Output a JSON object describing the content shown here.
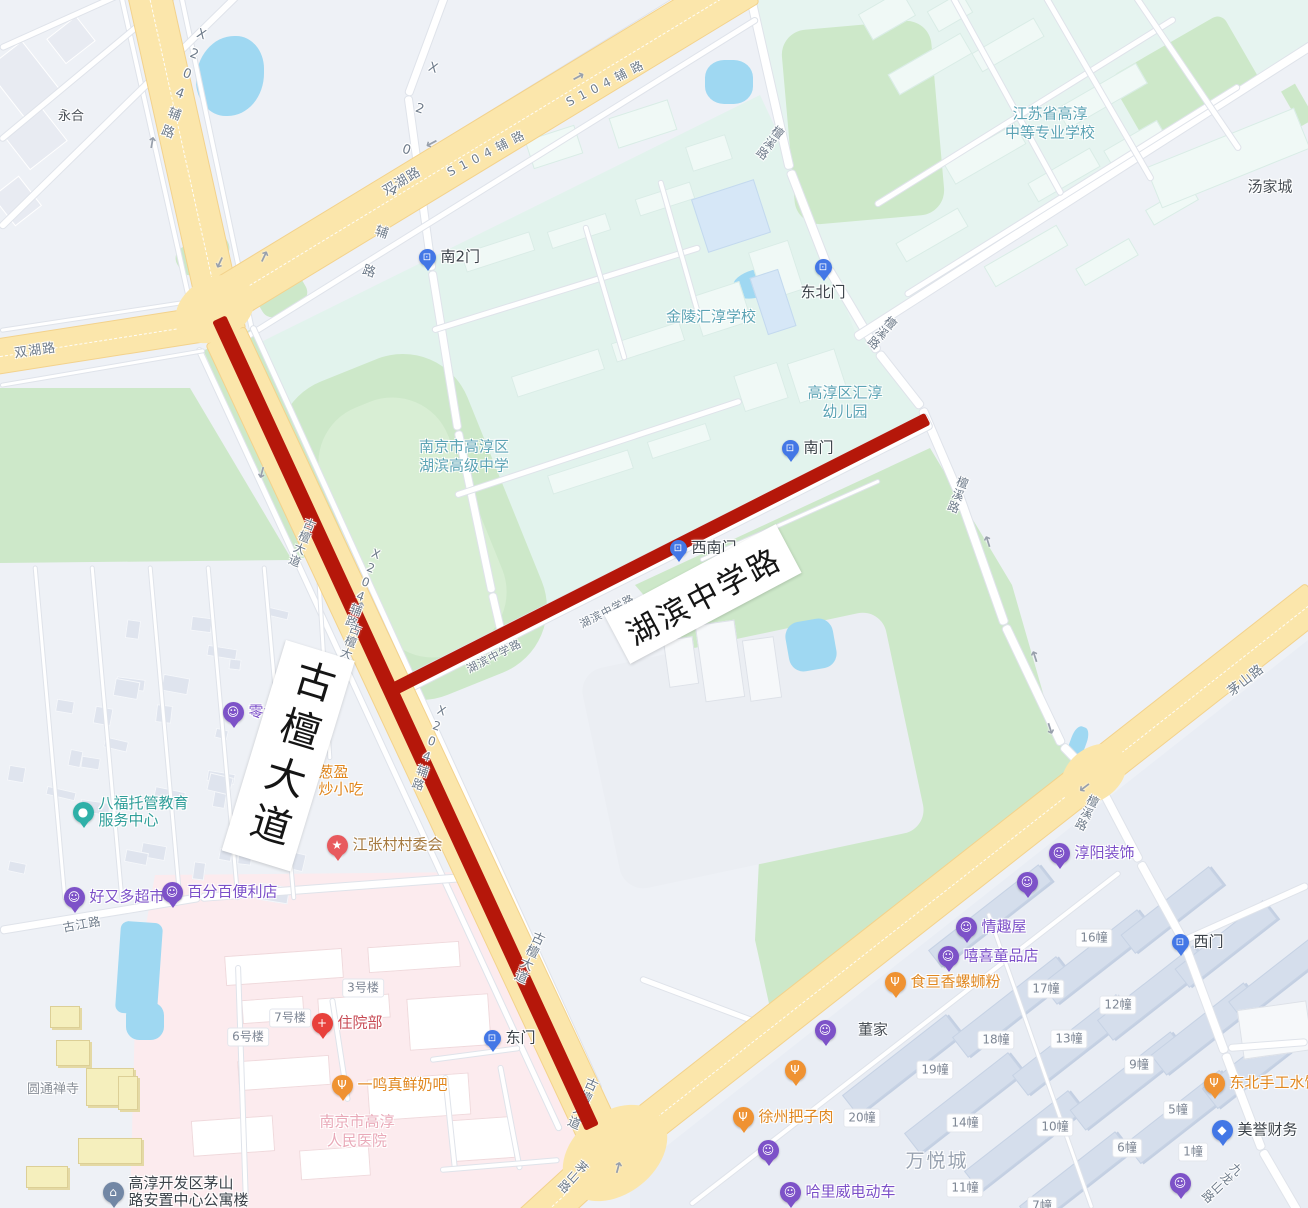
{
  "map_size": {
    "w": 1308,
    "h": 1208
  },
  "route": {
    "color": "#b5170a",
    "segments": [
      {
        "road": "古檀大道",
        "x1": 219,
        "y1": 318,
        "x2": 592,
        "y2": 1127,
        "w": 15
      },
      {
        "road": "湖滨中学路",
        "x1": 395,
        "y1": 688,
        "x2": 928,
        "y2": 418,
        "w": 13
      }
    ]
  },
  "highlight_labels": {
    "vertical": "古檀大道",
    "diagonal": "湖滨中学路"
  },
  "road_labels": [
    {
      "t": "双湖路",
      "x": 35,
      "y": 349,
      "r": -8,
      "s": 13
    },
    {
      "t": "双湖路",
      "x": 401,
      "y": 180,
      "r": -31,
      "s": 13
    },
    {
      "t": "S104辅路",
      "x": 488,
      "y": 152,
      "r": -27,
      "s": 12,
      "ls": 6
    },
    {
      "t": "S104辅路",
      "x": 607,
      "y": 82,
      "r": -27,
      "s": 12,
      "ls": 6
    },
    {
      "t": "X204辅路",
      "x": 183,
      "y": 85,
      "r": 20,
      "v": 1,
      "s": 13,
      "ls": 6
    },
    {
      "t": "X204辅路",
      "x": 396,
      "y": 182,
      "r": 18,
      "v": 1,
      "s": 13,
      "ls": 28
    },
    {
      "t": "X204辅路",
      "x": 364,
      "y": 588,
      "r": 20,
      "v": 1,
      "s": 12,
      "ls": 1
    },
    {
      "t": "X204辅路",
      "x": 430,
      "y": 748,
      "r": 18,
      "v": 1,
      "s": 12,
      "ls": 2
    },
    {
      "t": "古檀大道辅路",
      "x": 344,
      "y": 660,
      "r": 20,
      "v": 1,
      "s": 12,
      "ls": 1
    },
    {
      "t": "古檀大道",
      "x": 302,
      "y": 543,
      "r": 22,
      "v": 1,
      "s": 12,
      "ls": 1
    },
    {
      "t": "古檀大道",
      "x": 528,
      "y": 957,
      "r": 24,
      "v": 1,
      "s": 13,
      "ls": 1
    },
    {
      "t": "古檀大道",
      "x": 581,
      "y": 1103,
      "r": 24,
      "v": 1,
      "s": 13,
      "ls": 1,
      "under": 1
    },
    {
      "t": "茅山路",
      "x": 1245,
      "y": 679,
      "r": -38,
      "s": 13
    },
    {
      "t": "茅山路",
      "x": 573,
      "y": 1177,
      "r": 42,
      "v": 1,
      "s": 12
    },
    {
      "t": "檀溪路",
      "x": 770,
      "y": 143,
      "r": 36,
      "v": 1,
      "s": 12
    },
    {
      "t": "檀溪路",
      "x": 882,
      "y": 333,
      "r": 40,
      "v": 1,
      "s": 12
    },
    {
      "t": "檀溪路",
      "x": 958,
      "y": 495,
      "r": 20,
      "v": 1,
      "s": 12
    },
    {
      "t": "檀溪路",
      "x": 1087,
      "y": 813,
      "r": 26,
      "v": 1,
      "s": 12
    },
    {
      "t": "九龙山路",
      "x": 1222,
      "y": 1183,
      "r": 46,
      "v": 1,
      "s": 12
    },
    {
      "t": "古江路",
      "x": 82,
      "y": 924,
      "r": -10,
      "s": 12
    },
    {
      "t": "湖滨中学路",
      "x": 494,
      "y": 656,
      "r": -27,
      "s": 11
    },
    {
      "t": "湖滨中学路",
      "x": 607,
      "y": 611,
      "r": -27,
      "s": 11
    }
  ],
  "area_labels": [
    {
      "lines": [
        "金陵汇淳学校"
      ],
      "x": 711,
      "y": 317,
      "cls": "teal",
      "s": 15
    },
    {
      "lines": [
        "高淳区汇淳",
        "幼儿园"
      ],
      "x": 845,
      "y": 402,
      "cls": "teal",
      "s": 15
    },
    {
      "lines": [
        "南京市高淳区",
        "湖滨高级中学"
      ],
      "x": 464,
      "y": 456,
      "cls": "teal",
      "s": 15
    },
    {
      "lines": [
        "江苏省高淳",
        "中等专业学校"
      ],
      "x": 1050,
      "y": 123,
      "cls": "teal",
      "s": 15
    },
    {
      "lines": [
        "永合"
      ],
      "x": 71,
      "y": 117,
      "cls": "dark",
      "s": 13
    },
    {
      "lines": [
        "汤家城"
      ],
      "x": 1270,
      "y": 187,
      "cls": "dark",
      "s": 15
    },
    {
      "lines": [
        "董家"
      ],
      "x": 873,
      "y": 1030,
      "cls": "dark",
      "s": 15
    },
    {
      "lines": [
        "万悦城"
      ],
      "x": 937,
      "y": 1162,
      "cls": "big-gray",
      "s": 19
    },
    {
      "lines": [
        "圆通禅寺"
      ],
      "x": 53,
      "y": 1090,
      "cls": "gray",
      "s": 13
    },
    {
      "lines": [
        "南京市高淳",
        "人民医院"
      ],
      "x": 357,
      "y": 1131,
      "cls": "pink",
      "s": 15
    }
  ],
  "building_labels": [
    {
      "t": "3号楼",
      "x": 363,
      "y": 988
    },
    {
      "t": "7号楼",
      "x": 290,
      "y": 1018
    },
    {
      "t": "6号楼",
      "x": 248,
      "y": 1037
    },
    {
      "t": "16幢",
      "x": 1094,
      "y": 938
    },
    {
      "t": "17幢",
      "x": 1046,
      "y": 989
    },
    {
      "t": "12幢",
      "x": 1118,
      "y": 1005
    },
    {
      "t": "18幢",
      "x": 996,
      "y": 1040
    },
    {
      "t": "13幢",
      "x": 1069,
      "y": 1039
    },
    {
      "t": "9幢",
      "x": 1139,
      "y": 1065
    },
    {
      "t": "19幢",
      "x": 935,
      "y": 1070
    },
    {
      "t": "20幢",
      "x": 862,
      "y": 1118
    },
    {
      "t": "14幢",
      "x": 965,
      "y": 1123
    },
    {
      "t": "10幢",
      "x": 1055,
      "y": 1127
    },
    {
      "t": "5幢",
      "x": 1178,
      "y": 1110
    },
    {
      "t": "6幢",
      "x": 1127,
      "y": 1148
    },
    {
      "t": "1幢",
      "x": 1193,
      "y": 1152
    },
    {
      "t": "11幢",
      "x": 965,
      "y": 1188
    },
    {
      "t": "7幢",
      "x": 1042,
      "y": 1206
    }
  ],
  "pois": [
    {
      "t": "零食铺",
      "x": 233,
      "y": 712,
      "c": "purple",
      "i": "bag",
      "side": "right"
    },
    {
      "lines": [
        "葱盈",
        "炒小吃"
      ],
      "x": 303,
      "y": 781,
      "c": "orange",
      "i": "food",
      "side": "right",
      "align": "left"
    },
    {
      "lines": [
        "八福托管教育",
        "服务中心"
      ],
      "x": 83,
      "y": 812,
      "c": "teal",
      "i": "edu",
      "side": "right",
      "align": "left"
    },
    {
      "t": "江张村村委会",
      "x": 337,
      "y": 845,
      "c": "red",
      "i": "star",
      "side": "right",
      "tc": "brown"
    },
    {
      "t": "好又多超市",
      "x": 74,
      "y": 897,
      "c": "purple",
      "i": "bag",
      "side": "right"
    },
    {
      "t": "百分百便利店",
      "x": 172,
      "y": 892,
      "c": "purple",
      "i": "bag",
      "side": "right"
    },
    {
      "t": "住院部",
      "x": 322,
      "y": 1023,
      "c": "cross",
      "i": "cross",
      "side": "right",
      "tc": "crimson"
    },
    {
      "t": "一鸣真鲜奶吧",
      "x": 342,
      "y": 1085,
      "c": "orange",
      "i": "food",
      "side": "right"
    },
    {
      "t": "东门",
      "x": 492,
      "y": 1038,
      "c": "blue",
      "i": "gate",
      "side": "right",
      "tc": "dark"
    },
    {
      "t": "南2门",
      "x": 427,
      "y": 257,
      "c": "blue",
      "i": "gate",
      "side": "right",
      "tc": "dark"
    },
    {
      "t": "东北门",
      "x": 823,
      "y": 267,
      "c": "blue",
      "i": "gate",
      "side": "below",
      "tc": "dark"
    },
    {
      "t": "南门",
      "x": 790,
      "y": 448,
      "c": "blue",
      "i": "gate",
      "side": "right",
      "tc": "dark"
    },
    {
      "t": "西南门",
      "x": 678,
      "y": 548,
      "c": "blue",
      "i": "gate",
      "side": "right",
      "tc": "dark"
    },
    {
      "t": "西门",
      "x": 1180,
      "y": 942,
      "c": "blue",
      "i": "gate",
      "side": "right",
      "tc": "dark"
    },
    {
      "t": "淳阳装饰",
      "x": 1059,
      "y": 853,
      "c": "purple",
      "i": "bag",
      "side": "right"
    },
    {
      "t": "魔鼓音乐",
      "x": 1027,
      "y": 882,
      "c": "purple",
      "i": "bag",
      "side": "left"
    },
    {
      "t": "情趣屋",
      "x": 966,
      "y": 927,
      "c": "purple",
      "i": "bag",
      "side": "right"
    },
    {
      "t": "嘻喜童品店",
      "x": 948,
      "y": 956,
      "c": "purple",
      "i": "bag",
      "side": "right"
    },
    {
      "t": "食亘香螺蛳粉",
      "x": 895,
      "y": 982,
      "c": "orange",
      "i": "food",
      "side": "right"
    },
    {
      "t": "星辰服饰",
      "x": 825,
      "y": 1030,
      "c": "purple",
      "i": "bag",
      "side": "left"
    },
    {
      "lines": [
        "美妙时刻",
        "肠粉·煎饼"
      ],
      "x": 795,
      "y": 1070,
      "c": "orange",
      "i": "food",
      "side": "left",
      "align": "right"
    },
    {
      "t": "徐州把子肉",
      "x": 743,
      "y": 1117,
      "c": "orange",
      "i": "food",
      "side": "right"
    },
    {
      "t": "新尚烟酒",
      "x": 768,
      "y": 1150,
      "c": "purple",
      "i": "bag",
      "side": "left"
    },
    {
      "t": "哈里威电动车",
      "x": 790,
      "y": 1192,
      "c": "purple",
      "i": "bag",
      "side": "right"
    },
    {
      "t": "东北手工水饺",
      "x": 1214,
      "y": 1083,
      "c": "orange",
      "i": "food",
      "side": "right"
    },
    {
      "t": "美誉财务",
      "x": 1222,
      "y": 1130,
      "c": "blue",
      "i": "finance",
      "side": "right",
      "tc": "dark"
    },
    {
      "t": "春香烟酒",
      "x": 1180,
      "y": 1183,
      "c": "purple",
      "i": "bag",
      "side": "left"
    },
    {
      "lines": [
        "高淳开发区茅山",
        "路安置中心公寓楼"
      ],
      "x": 113,
      "y": 1192,
      "c": "slate",
      "i": "building",
      "side": "right",
      "align": "left",
      "tc": "dark"
    }
  ],
  "icons": {
    "bag": "☺",
    "food": "Ψ",
    "gate": "⊡",
    "star": "★",
    "cross": "+",
    "edu": "●",
    "building": "⌂",
    "finance": "◆",
    "arrow": "↑"
  },
  "colors": {
    "route": "#b5170a",
    "road_main": "#fbe6ab",
    "road_border": "#f3d28c",
    "campus": "#e2f3ed",
    "park": "#cde8c9",
    "water": "#9fd8f2",
    "hospital_area": "#fcebee",
    "poi_purple": "#7d52c8",
    "poi_orange": "#ef9232",
    "poi_blue": "#4377e6",
    "poi_teal": "#2fb0a8",
    "poi_red": "#e85a5e",
    "poi_slate": "#7287a5",
    "poi_cross": "#e8413c",
    "text_purple": "#7b4fc8",
    "text_orange": "#e0871f",
    "text_teal": "#2f9e99",
    "text_brown": "#a5793f",
    "text_crimson": "#c74a54",
    "text_dark": "#3b4249",
    "label_teal": "#5ba3b4",
    "label_gray": "#6e7b8a"
  }
}
